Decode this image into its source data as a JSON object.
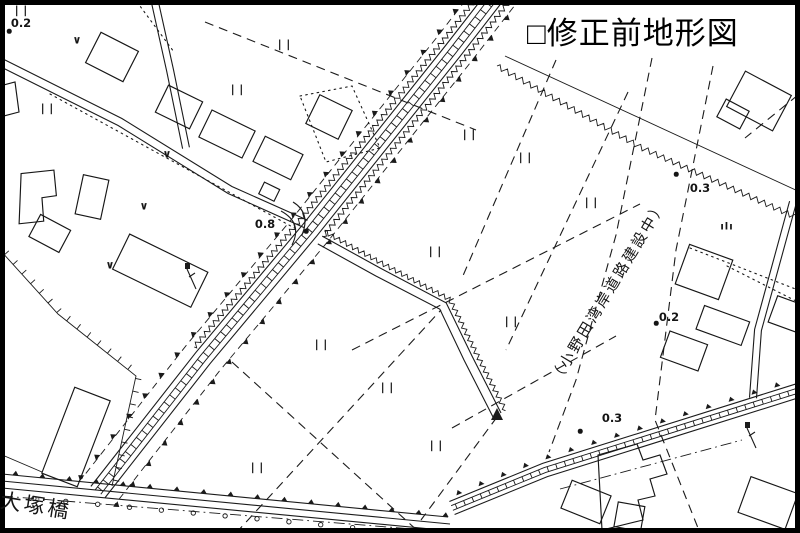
{
  "map": {
    "title": "□修正前地形図",
    "bridge_label": "大塚橋",
    "construction_label": "（小野田湾岸道路建設中）",
    "colors": {
      "ink": "#1b1b1b",
      "background": "#ffffff"
    },
    "symbols": {
      "rice_field": "||",
      "dry_field": "∨",
      "grass": "ılı"
    },
    "elevation_points": [
      {
        "value": "0.2",
        "x": 21,
        "y": 23,
        "dot": [
          9,
          31
        ]
      },
      {
        "value": "0.8",
        "x": 265,
        "y": 224,
        "dot": [
          306,
          231
        ]
      },
      {
        "value": "0.3",
        "x": 700,
        "y": 188,
        "dot": [
          676,
          174
        ]
      },
      {
        "value": "0.2",
        "x": 669,
        "y": 317,
        "dot": [
          656,
          323
        ]
      },
      {
        "value": "0.3",
        "x": 612,
        "y": 418,
        "dot": [
          580,
          431
        ]
      }
    ],
    "rice_fields": [
      [
        22,
        10
      ],
      [
        48,
        108
      ],
      [
        238,
        89
      ],
      [
        285,
        44
      ],
      [
        470,
        134
      ],
      [
        526,
        157
      ],
      [
        592,
        202
      ],
      [
        436,
        251
      ],
      [
        512,
        321
      ],
      [
        322,
        344
      ],
      [
        388,
        387
      ],
      [
        258,
        467
      ],
      [
        437,
        445
      ]
    ],
    "dry_fields": [
      [
        77,
        40
      ],
      [
        167,
        154
      ],
      [
        144,
        206
      ],
      [
        110,
        265
      ]
    ],
    "grass": [
      [
        727,
        227
      ]
    ]
  }
}
